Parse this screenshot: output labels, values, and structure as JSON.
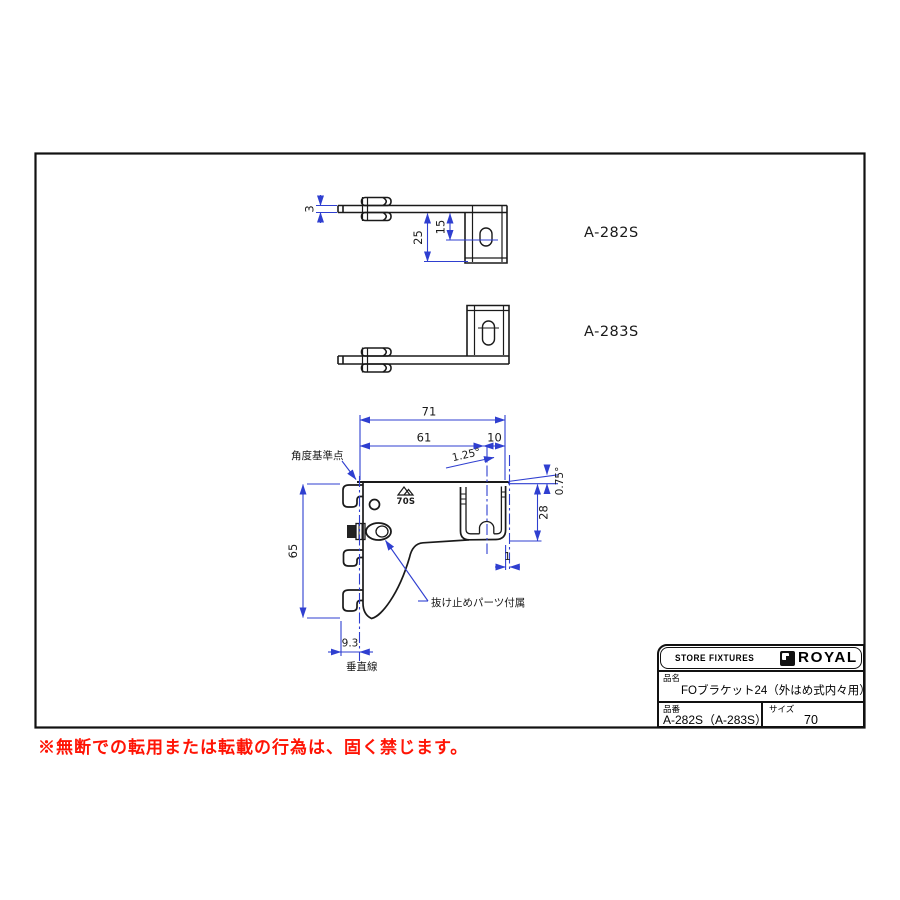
{
  "colors": {
    "dimension_blue": "#2f3fd0",
    "line_black": "#1a1a1a",
    "warning_red": "#ff1405"
  },
  "views": {
    "top_view_a282s": {
      "label": "A-282S",
      "dims": {
        "thickness": "3",
        "depth_total": "25",
        "slot_offset": "15"
      }
    },
    "top_view_a283s": {
      "label": "A-283S"
    },
    "side_view": {
      "dims": {
        "total_width": "71",
        "back_dim": "61",
        "tip_dim": "10",
        "slot_angle": "1.25°",
        "top_angle": "0.75°",
        "channel_height": "28",
        "back_height": "65",
        "hook_depth": "9.3",
        "tip_gap": "1"
      },
      "labels": {
        "stamp": "70S",
        "angle_ref": "角度基準点",
        "retainer_note": "抜け止めパーツ付属",
        "vertical_line": "垂直線"
      }
    }
  },
  "title_block": {
    "header_left": "STORE FIXTURES",
    "brand": "ROYAL",
    "name_label": "品名",
    "name_value": "FOブラケット24（外はめ式内々用）",
    "code_label": "品番",
    "code_value": "A-282S（A-283S）",
    "size_label": "サイズ",
    "size_value": "70"
  },
  "disclaimer": "※無断での転用または転載の行為は、固く禁じます。"
}
